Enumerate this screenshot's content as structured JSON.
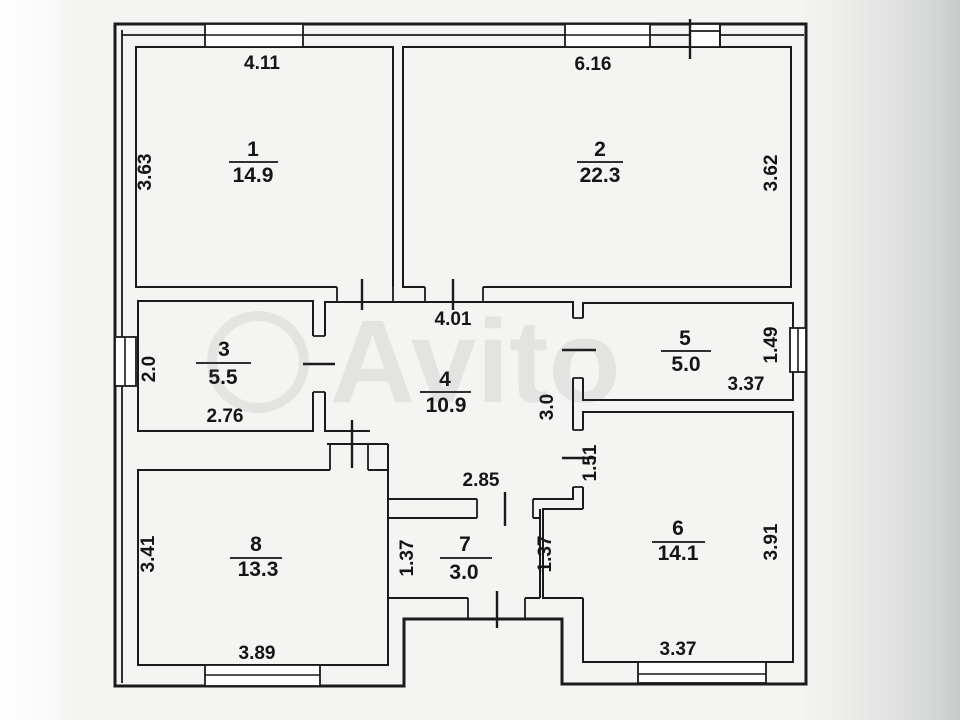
{
  "plan": {
    "watermark": "Avito",
    "rooms": [
      {
        "number": "1",
        "area": "14.9",
        "dims": {
          "top": "4.11",
          "left": "3.63"
        }
      },
      {
        "number": "2",
        "area": "22.3",
        "dims": {
          "top": "6.16",
          "right": "3.62"
        }
      },
      {
        "number": "3",
        "area": "5.5",
        "dims": {
          "left": "2.0",
          "bottom": "2.76"
        }
      },
      {
        "number": "4",
        "area": "10.9",
        "dims": {
          "top": "4.01",
          "bottom": "2.85",
          "right": "3.0",
          "right_lower": "1.51"
        }
      },
      {
        "number": "5",
        "area": "5.0",
        "dims": {
          "bottom": "3.37",
          "right": "1.49"
        }
      },
      {
        "number": "6",
        "area": "14.1",
        "dims": {
          "right": "3.91",
          "bottom": "3.37"
        }
      },
      {
        "number": "7",
        "area": "3.0",
        "dims": {
          "left": "1.37",
          "right": "1.37"
        }
      },
      {
        "number": "8",
        "area": "13.3",
        "dims": {
          "left": "3.41",
          "bottom": "3.89"
        }
      }
    ]
  }
}
